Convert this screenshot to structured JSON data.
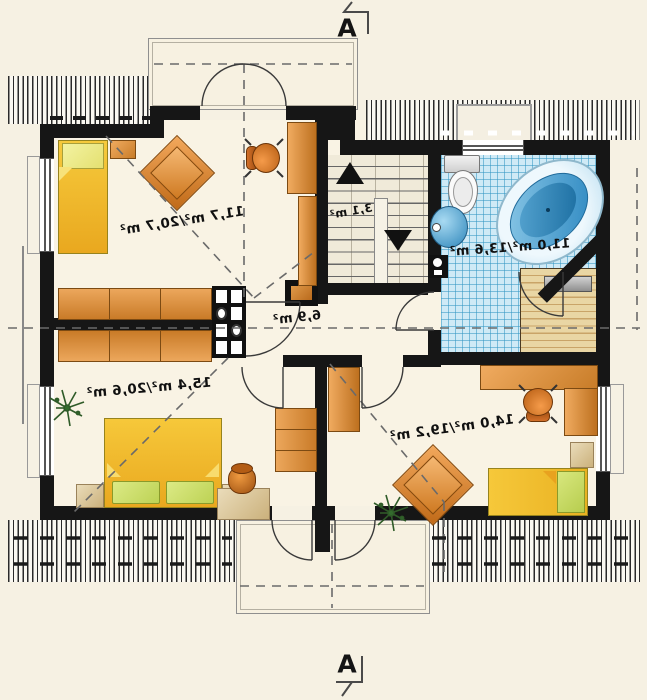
{
  "section_marks": {
    "top": "A",
    "bottom": "A"
  },
  "rooms": {
    "bedroom_top_left": {
      "area": "11,7 m²/20,7 m²"
    },
    "staircase": {
      "area": "3,1 m²"
    },
    "bathroom": {
      "area": "11,0 m²/13,6 m²"
    },
    "hall": {
      "area": "6,9 m²"
    },
    "bedroom_bottom_left": {
      "area": "15,4 m²/20,6 m²"
    },
    "bedroom_bottom_right": {
      "area": "14,0 m²/19,2 m²"
    }
  },
  "colors": {
    "background": "#f6f1e3",
    "wall": "#161616",
    "furniture_wood": "#d98a35",
    "bed_yellow": "#f3c22d",
    "pillow_green": "#cde069",
    "bathroom_tile": "#cfeaf6",
    "tub_blue": "#2f97cf",
    "sauna_wood": "#e7d3a0",
    "roof_hatch_line": "#2a2a2a",
    "dashed_line": "#6a6a6a"
  }
}
